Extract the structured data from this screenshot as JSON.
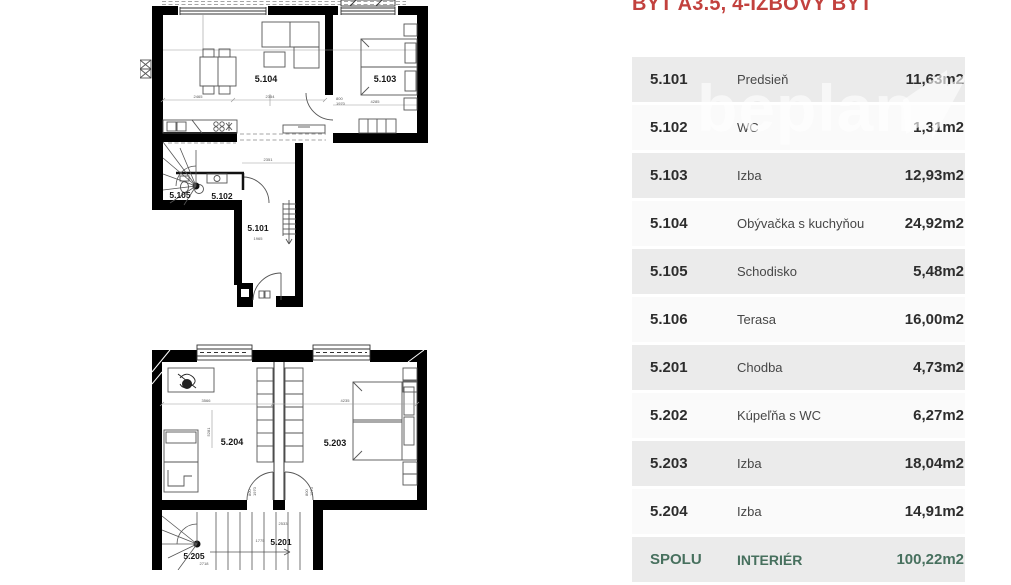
{
  "title": "BYT A3.5, 4-IZBOVÝ BYT",
  "watermark": {
    "text": "beplan",
    "logo": "beplan-flag-logo"
  },
  "table": {
    "rows": [
      {
        "num": "5.101",
        "name": "Predsieň",
        "area": "11,63m2"
      },
      {
        "num": "5.102",
        "name": "WC",
        "area": "1,31m2"
      },
      {
        "num": "5.103",
        "name": "Izba",
        "area": "12,93m2"
      },
      {
        "num": "5.104",
        "name": "Obývačka s kuchyňou",
        "area": "24,92m2"
      },
      {
        "num": "5.105",
        "name": "Schodisko",
        "area": "5,48m2"
      },
      {
        "num": "5.106",
        "name": "Terasa",
        "area": "16,00m2"
      },
      {
        "num": "5.201",
        "name": "Chodba",
        "area": "4,73m2"
      },
      {
        "num": "5.202",
        "name": "Kúpeľňa s WC",
        "area": "6,27m2"
      },
      {
        "num": "5.203",
        "name": "Izba",
        "area": "18,04m2"
      },
      {
        "num": "5.204",
        "name": "Izba",
        "area": "14,91m2"
      }
    ],
    "footer": {
      "num": "SPOLU",
      "name": "INTERIÉR",
      "area": "100,22m2"
    }
  },
  "floor_plans": {
    "plan1": {
      "labels": {
        "r101": "5.101",
        "r102": "5.102",
        "r103": "5.103",
        "r104": "5.104",
        "r105": "5.105"
      },
      "dims": {
        "d1": "2465",
        "d2": "2354",
        "d3": "4285",
        "d4": "2351",
        "d5": "1965",
        "door_w": "800",
        "door_h": "1970"
      }
    },
    "plan2": {
      "labels": {
        "r201": "5.201",
        "r203": "5.203",
        "r204": "5.204",
        "r205": "5.205"
      },
      "dims": {
        "d1": "3566",
        "d2": "4235",
        "d3": "2533",
        "d4": "1775",
        "d5": "2718",
        "d6": "5281",
        "door_w": "800",
        "door_h": "1970"
      }
    }
  },
  "colors": {
    "accent_red": "#c2413e",
    "footer_green": "#47705e",
    "row_gray": "#ebebeb",
    "row_light": "#fafafa",
    "wall_black": "#000000",
    "watermark_white": "#ffffff"
  }
}
